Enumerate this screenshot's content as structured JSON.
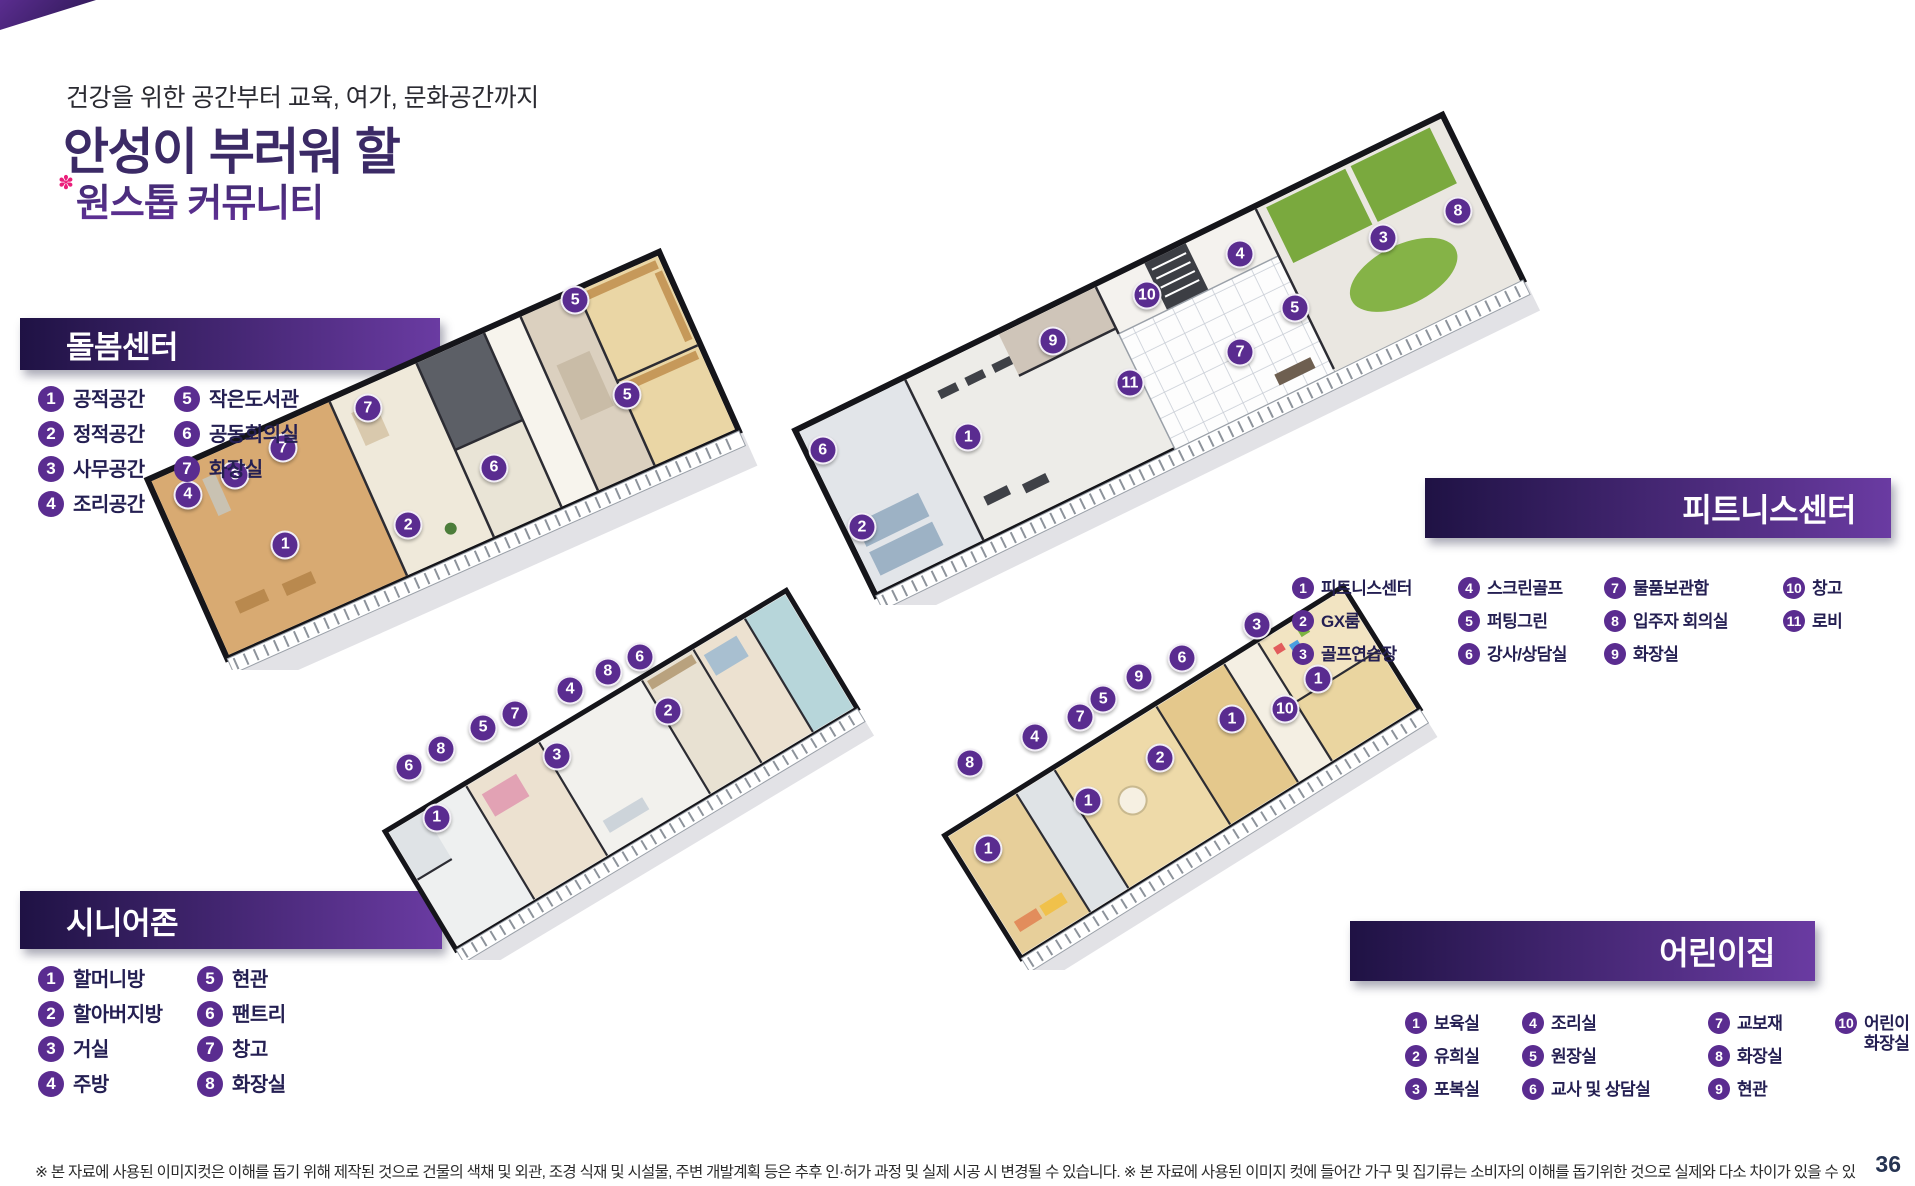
{
  "page": {
    "kicker": "건강을 위한 공간부터 교육, 여가, 문화공간까지",
    "title": "안성이 부러워 할",
    "subtitle": "원스톱 커뮤니티",
    "subtitle_mark": "✽",
    "page_number": "36",
    "disclaimer": "※ 본 자료에 사용된 이미지컷은 이해를 돕기 위해 제작된 것으로 건물의 색채 및 외관, 조경 식재 및 시설물, 주변 개발계획 등은 추후 인·허가 과정 및 실제 시공 시 변경될 수 있습니다. ※ 본 자료에 사용된 이미지 컷에 들어간 가구 및 집기류는 소비자의 이해를 돕기위한 것으로 실제와 다소 차이가 있을 수 있습니다."
  },
  "colors": {
    "banner-dark": "#1f1244",
    "banner-light": "#6a3ba2",
    "badge-purple": "#5a2c90",
    "title-navy": "#3b2a66",
    "subtitle-purple": "#4e2a83",
    "flower-pink": "#ea1f7b",
    "label-navy": "#241f52"
  },
  "sections": {
    "care": {
      "title": "돌봄센터",
      "legend_columns": [
        [
          {
            "n": "1",
            "label": "공적공간"
          },
          {
            "n": "2",
            "label": "정적공간"
          },
          {
            "n": "3",
            "label": "사무공간"
          },
          {
            "n": "4",
            "label": "조리공간"
          }
        ],
        [
          {
            "n": "5",
            "label": "작은도서관"
          },
          {
            "n": "6",
            "label": "공동회의실"
          },
          {
            "n": "7",
            "label": "화장실"
          }
        ]
      ],
      "badges": [
        {
          "n": "5",
          "x": 70.8,
          "y": 17.8
        },
        {
          "n": "7",
          "x": 38.9,
          "y": 41.8
        },
        {
          "n": "5",
          "x": 78.8,
          "y": 38.9
        },
        {
          "n": "7",
          "x": 25.8,
          "y": 50.7
        },
        {
          "n": "3",
          "x": 18.5,
          "y": 56.7
        },
        {
          "n": "6",
          "x": 58.3,
          "y": 55.1
        },
        {
          "n": "4",
          "x": 11.2,
          "y": 61.1
        },
        {
          "n": "2",
          "x": 45.1,
          "y": 67.8
        },
        {
          "n": "1",
          "x": 26.2,
          "y": 72.2
        }
      ]
    },
    "fitness": {
      "title": "피트니스센터",
      "legend_columns": [
        [
          {
            "n": "1",
            "label": "피트니스센터"
          },
          {
            "n": "2",
            "label": "GX룸"
          },
          {
            "n": "3",
            "label": "골프연습장"
          }
        ],
        [
          {
            "n": "4",
            "label": "스크린골프"
          },
          {
            "n": "5",
            "label": "퍼팅그린"
          },
          {
            "n": "6",
            "label": "강사/상담실"
          }
        ],
        [
          {
            "n": "7",
            "label": "물품보관함"
          },
          {
            "n": "8",
            "label": "입주자 회의실"
          },
          {
            "n": "9",
            "label": "화장실"
          }
        ],
        [
          {
            "n": "10",
            "label": "창고"
          },
          {
            "n": "11",
            "label": "로비"
          }
        ]
      ],
      "badges": [
        {
          "n": "8",
          "x": 88.7,
          "y": 21.2
        },
        {
          "n": "3",
          "x": 79.0,
          "y": 26.6
        },
        {
          "n": "4",
          "x": 60.4,
          "y": 29.8
        },
        {
          "n": "10",
          "x": 48.3,
          "y": 38.0
        },
        {
          "n": "5",
          "x": 67.5,
          "y": 40.6
        },
        {
          "n": "9",
          "x": 36.1,
          "y": 47.2
        },
        {
          "n": "7",
          "x": 60.4,
          "y": 49.4
        },
        {
          "n": "11",
          "x": 46.1,
          "y": 55.6
        },
        {
          "n": "1",
          "x": 25.1,
          "y": 66.4
        },
        {
          "n": "6",
          "x": 6.2,
          "y": 69.0
        },
        {
          "n": "2",
          "x": 11.3,
          "y": 84.4
        }
      ]
    },
    "senior": {
      "title": "시니어존",
      "legend_columns": [
        [
          {
            "n": "1",
            "label": "할머니방"
          },
          {
            "n": "2",
            "label": "할아버지방"
          },
          {
            "n": "3",
            "label": "거실"
          },
          {
            "n": "4",
            "label": "주방"
          }
        ],
        [
          {
            "n": "5",
            "label": "현관"
          },
          {
            "n": "6",
            "label": "팬트리"
          },
          {
            "n": "7",
            "label": "창고"
          },
          {
            "n": "8",
            "label": "화장실"
          }
        ]
      ],
      "badges": [
        {
          "n": "6",
          "x": 53.4,
          "y": 20.3
        },
        {
          "n": "8",
          "x": 47.9,
          "y": 24.2
        },
        {
          "n": "4",
          "x": 41.4,
          "y": 28.9
        },
        {
          "n": "2",
          "x": 58.3,
          "y": 34.5
        },
        {
          "n": "7",
          "x": 31.9,
          "y": 35.3
        },
        {
          "n": "5",
          "x": 26.4,
          "y": 38.9
        },
        {
          "n": "3",
          "x": 39.1,
          "y": 46.3
        },
        {
          "n": "8",
          "x": 19.1,
          "y": 44.5
        },
        {
          "n": "6",
          "x": 13.6,
          "y": 49.2
        },
        {
          "n": "1",
          "x": 18.4,
          "y": 62.6
        }
      ]
    },
    "children": {
      "title": "어린이집",
      "legend_columns": [
        [
          {
            "n": "1",
            "label": "보육실"
          },
          {
            "n": "2",
            "label": "유희실"
          },
          {
            "n": "3",
            "label": "포복실"
          }
        ],
        [
          {
            "n": "4",
            "label": "조리실"
          },
          {
            "n": "5",
            "label": "원장실"
          },
          {
            "n": "6",
            "label": "교사 및 상담실"
          }
        ],
        [
          {
            "n": "7",
            "label": "교보재"
          },
          {
            "n": "8",
            "label": "화장실"
          },
          {
            "n": "9",
            "label": "현관"
          }
        ],
        [
          {
            "n": "10",
            "label": "어린이\n화장실"
          }
        ]
      ],
      "badges": [
        {
          "n": "3",
          "x": 62.9,
          "y": 13.8
        },
        {
          "n": "6",
          "x": 49.9,
          "y": 22.0
        },
        {
          "n": "9",
          "x": 42.4,
          "y": 26.8
        },
        {
          "n": "1",
          "x": 73.6,
          "y": 27.3
        },
        {
          "n": "5",
          "x": 36.2,
          "y": 32.3
        },
        {
          "n": "10",
          "x": 67.8,
          "y": 34.8
        },
        {
          "n": "7",
          "x": 32.2,
          "y": 36.8
        },
        {
          "n": "1",
          "x": 58.6,
          "y": 37.3
        },
        {
          "n": "4",
          "x": 24.3,
          "y": 41.8
        },
        {
          "n": "2",
          "x": 46.1,
          "y": 47.0
        },
        {
          "n": "8",
          "x": 13.0,
          "y": 48.3
        },
        {
          "n": "1",
          "x": 33.6,
          "y": 57.8
        },
        {
          "n": "1",
          "x": 16.2,
          "y": 69.8
        }
      ]
    }
  }
}
